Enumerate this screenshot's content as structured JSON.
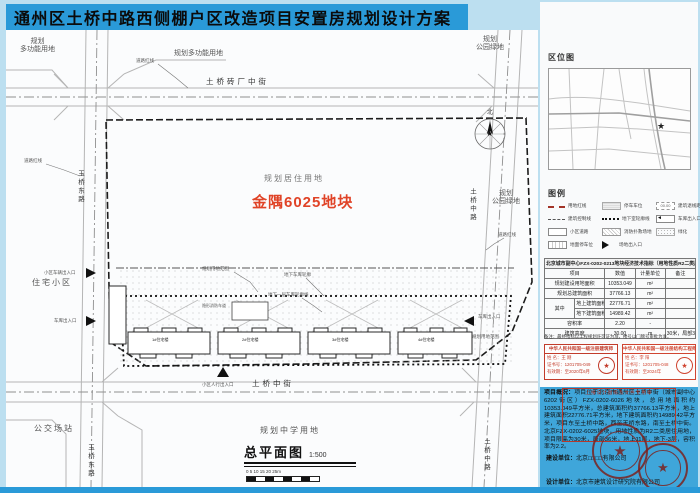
{
  "title": "通州区土桥中路西侧棚户区改造项目安置房规划设计方案",
  "plan": {
    "areas": {
      "top_left_1": "规划",
      "top_left_2": "多功能用地",
      "top_center": "规划多功能用地",
      "top_right_1": "规划",
      "top_right_2": "公园绿地",
      "right_1": "规划",
      "right_2": "公园绿地",
      "left": "住宅小区",
      "bottom_left": "公交场站",
      "bottom": "规划中学用地"
    },
    "streets": {
      "top": "土桥砖厂中街",
      "bottom": "土桥中街",
      "left": "玉桥东路",
      "right": "土桥中路"
    },
    "site": {
      "use": "规划居住用地",
      "name": "金隅6025地块"
    },
    "labels": {
      "road_redline": "道路红线",
      "site_extent": "规划用地范围",
      "garage_outline": "地下车库轮廓",
      "garage_b1_outline": "地下一层车库轮廓线",
      "ped_entrance": "小区人行出入口",
      "vehicle_entrance": "小区车辆出入口",
      "garage_entrance": "车库出入口",
      "fire_lane": "隐形消防车道",
      "north": "北"
    },
    "buildings": [
      "1#住宅楼",
      "2#住宅楼",
      "3#住宅楼",
      "4#住宅楼"
    ],
    "caption": {
      "title": "总平面图",
      "scale": "1:500",
      "ticks": "0  5  10  15  20  25m"
    },
    "compass_star": "★"
  },
  "sidebar": {
    "location_map": {
      "heading": "区位图",
      "marker": "★"
    },
    "legend": {
      "heading": "图例",
      "coord_symbol": "00.00",
      "garage_arrow": "◄",
      "items": [
        {
          "label": "用地红线"
        },
        {
          "label": "建筑控制线"
        },
        {
          "label": "小区道路"
        },
        {
          "label": "地面停车位"
        },
        {
          "label": "停车车位"
        },
        {
          "label": "地下室轮廓线"
        },
        {
          "label": "消防扑救场地"
        },
        {
          "label": "场地出入口"
        },
        {
          "label": "建筑退线距离"
        },
        {
          "label": "车库出入口"
        },
        {
          "label": "绿化"
        }
      ]
    },
    "table": {
      "title": "北京城市副中心FZX-0202-0213地块经济技术指标（用地性质R2二类居住用地）",
      "columns": [
        "项目",
        "数值",
        "计量单位",
        "备注"
      ],
      "group_label": "其中",
      "rows": [
        {
          "item": "规划建设用地面积",
          "value": "10353.049",
          "unit": "m²",
          "note": ""
        },
        {
          "item": "规划总建筑面积",
          "value": "37766.13",
          "unit": "m²",
          "note": ""
        },
        {
          "item": "地上建筑面积",
          "value": "22776.71",
          "unit": "m²",
          "note": ""
        },
        {
          "item": "地下建筑面积",
          "value": "14989.42",
          "unit": "m²",
          "note": ""
        },
        {
          "item": "容积率",
          "value": "2.20",
          "unit": "-",
          "note": ""
        },
        {
          "item": "建筑高度",
          "value": "30.00",
          "unit": "m",
          "note": "30米，局部36米"
        }
      ],
      "footnote": "备注：最终指标以工程规划许可证为准，楼号以门牌号审批为准。"
    },
    "stamps": {
      "architect": {
        "title": "中华人民共和国一级注册建筑师",
        "name": "姓 名：王 刚",
        "cert": "证书号：1201705-049",
        "valid": "有效期：至2020年6月",
        "seal": "★"
      },
      "engineer": {
        "title": "中华人民共和国一级注册结构工程师",
        "name": "姓 名：李 阳",
        "cert": "证书号：1201705-048",
        "valid": "有效期：至2024年",
        "seal": "★"
      }
    },
    "overview": {
      "label": "项目概况：",
      "text": "项目位于北京市通州区土桥中街（城市副中心6202街区）FZX-0202-6026地块，总用地面积约10353.049平方米，总建筑面积约37766.13平方米，地上建筑面积22776.71平方米，地下建筑面积约14989.42平方米，项目东至土桥中路，西至玉桥东路，南至土桥中街。北京FZX-0202-6025地块，用地性质为R2二类居住用地，项目限高为30米，局部36米，地上11层，地下-3层，容积率为2.2。",
      "stamp_box": "上报设计图纸及文件专用章",
      "builder_label": "建设单位：",
      "builder": "北京□□□□有限公司",
      "designer_label": "设计单位：",
      "designer": "北京市建筑设计研究院有限公司",
      "seal_star": "★"
    }
  },
  "colors": {
    "accent_blue": "#2a9ad8",
    "site_red": "#e04327",
    "stamp_red": "#c23b2a",
    "seal_maroon": "#7c2320"
  }
}
